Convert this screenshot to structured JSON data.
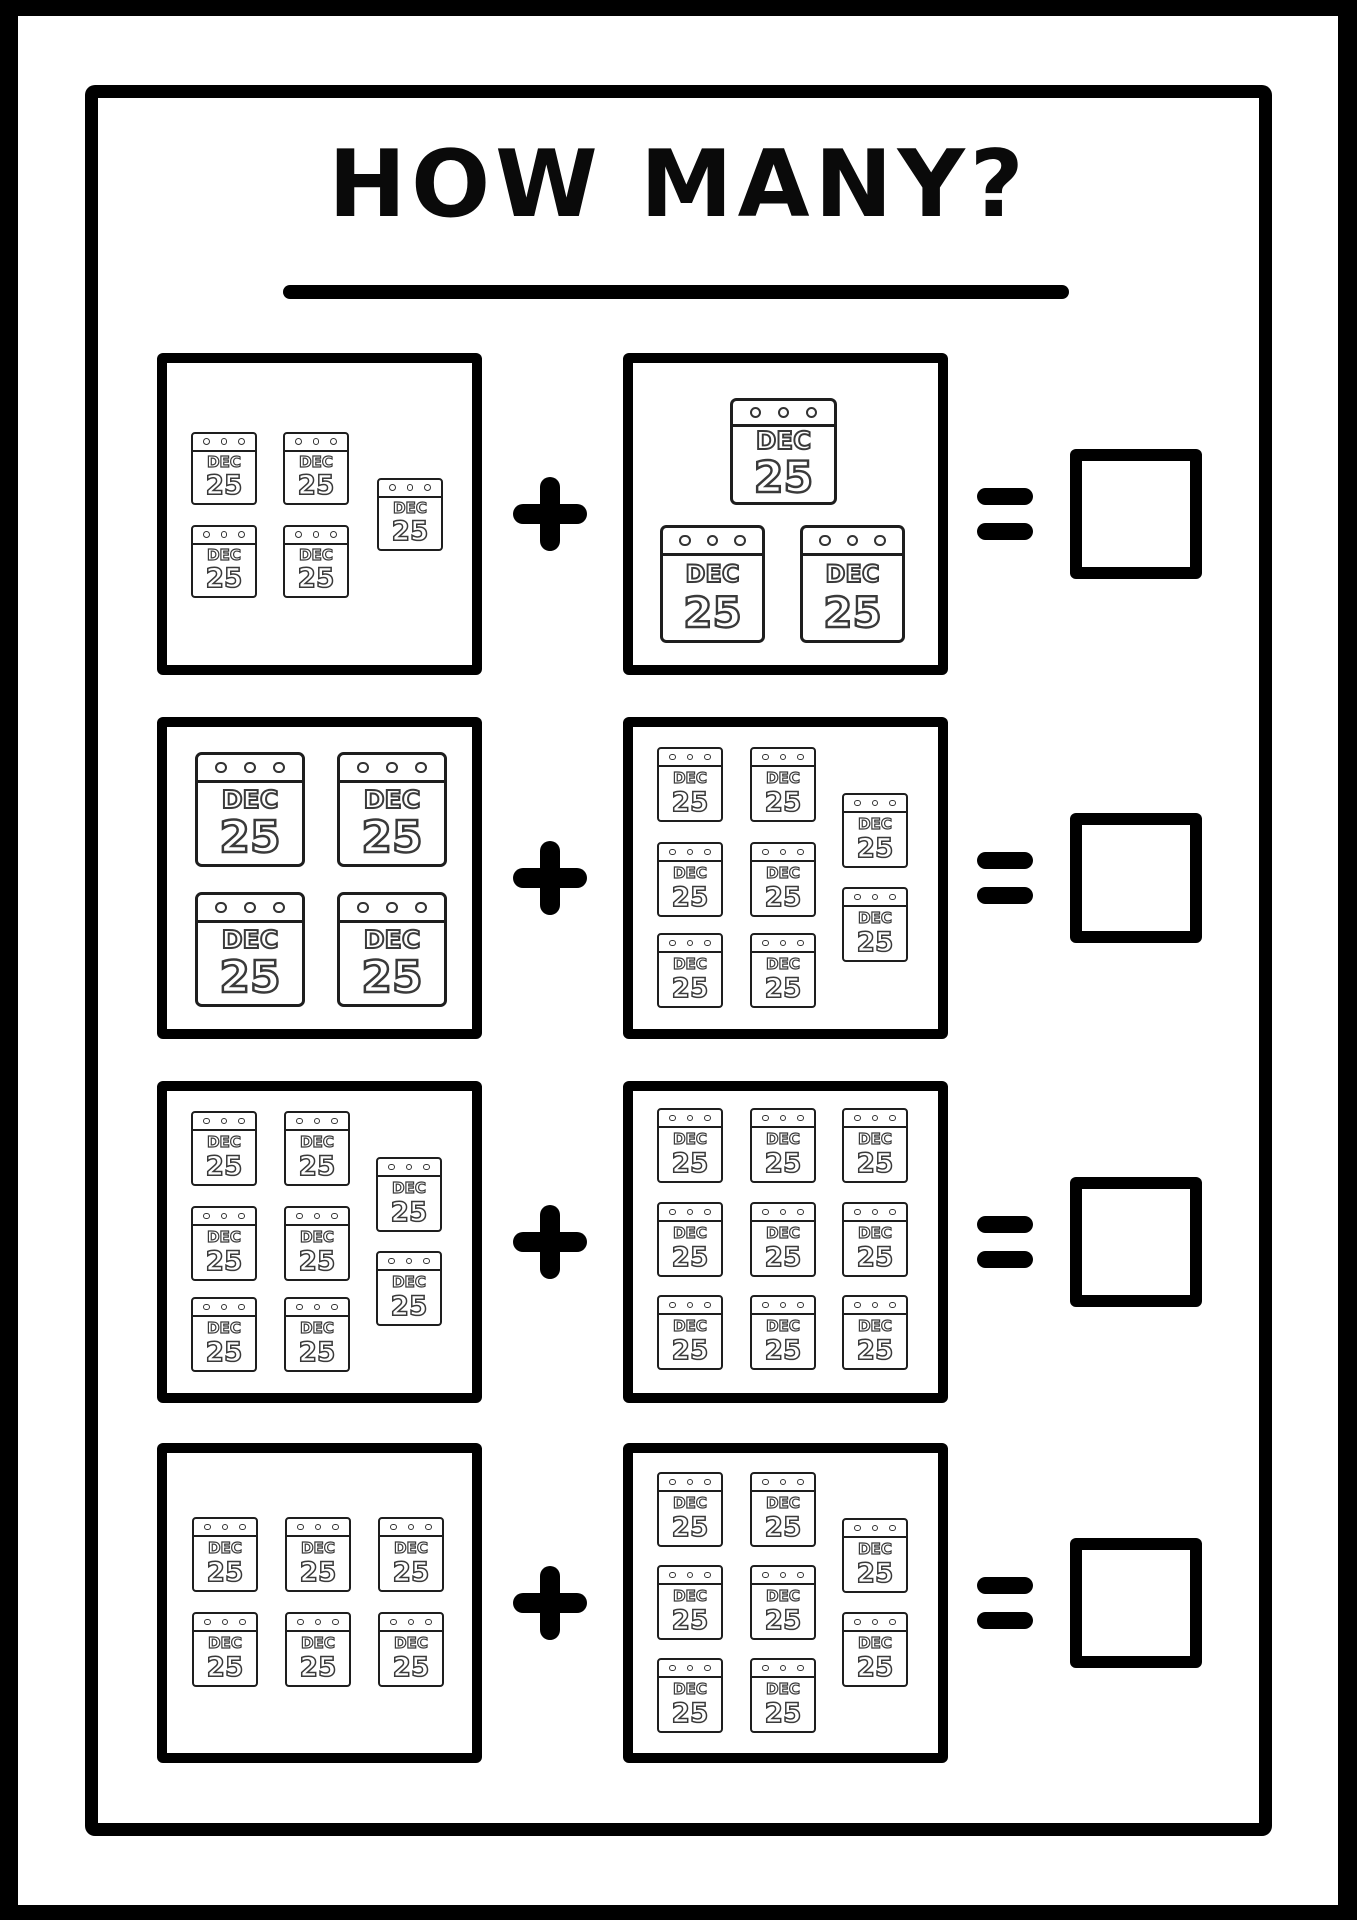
{
  "page": {
    "title": "HOW MANY?",
    "background": "#ffffff",
    "ink_color": "#000000"
  },
  "calendar_icon": {
    "name": "calendar-dec-25-icon",
    "month": "DEC",
    "day": "25",
    "line_color": "#1e1e1e",
    "glyph_outline_color": "#3a3a3a"
  },
  "equation": {
    "plus_symbol": "+",
    "equals_symbol": "=",
    "answer_value": ""
  },
  "rows": [
    {
      "row_label": "row-1",
      "left_count": 5,
      "right_count": 3,
      "left_calendars": [
        [
          34,
          79,
          66,
          73
        ],
        [
          126,
          79,
          66,
          73
        ],
        [
          34,
          172,
          66,
          73
        ],
        [
          126,
          172,
          66,
          73
        ],
        [
          220,
          125,
          66,
          73
        ]
      ],
      "right_calendars": [
        [
          107,
          45,
          107,
          107
        ],
        [
          37,
          172,
          105,
          118
        ],
        [
          177,
          172,
          105,
          118
        ]
      ]
    },
    {
      "row_label": "row-2",
      "left_count": 4,
      "right_count": 8,
      "left_calendars": [
        [
          38,
          35,
          110,
          115
        ],
        [
          180,
          35,
          110,
          115
        ],
        [
          38,
          175,
          110,
          115
        ],
        [
          180,
          175,
          110,
          115
        ]
      ],
      "right_calendars": [
        [
          34,
          30,
          66,
          75
        ],
        [
          127,
          30,
          66,
          75
        ],
        [
          34,
          125,
          66,
          75
        ],
        [
          127,
          125,
          66,
          75
        ],
        [
          34,
          216,
          66,
          75
        ],
        [
          127,
          216,
          66,
          75
        ],
        [
          219,
          76,
          66,
          75
        ],
        [
          219,
          170,
          66,
          75
        ]
      ]
    },
    {
      "row_label": "row-3",
      "left_count": 8,
      "right_count": 9,
      "left_calendars": [
        [
          34,
          30,
          66,
          75
        ],
        [
          127,
          30,
          66,
          75
        ],
        [
          34,
          125,
          66,
          75
        ],
        [
          127,
          125,
          66,
          75
        ],
        [
          34,
          216,
          66,
          75
        ],
        [
          127,
          216,
          66,
          75
        ],
        [
          219,
          76,
          66,
          75
        ],
        [
          219,
          170,
          66,
          75
        ]
      ],
      "right_calendars": [
        [
          34,
          27,
          66,
          75
        ],
        [
          127,
          27,
          66,
          75
        ],
        [
          219,
          27,
          66,
          75
        ],
        [
          34,
          121,
          66,
          75
        ],
        [
          127,
          121,
          66,
          75
        ],
        [
          219,
          121,
          66,
          75
        ],
        [
          34,
          214,
          66,
          75
        ],
        [
          127,
          214,
          66,
          75
        ],
        [
          219,
          214,
          66,
          75
        ]
      ]
    },
    {
      "row_label": "row-4",
      "left_count": 6,
      "right_count": 8,
      "left_calendars": [
        [
          35,
          74,
          66,
          75
        ],
        [
          128,
          74,
          66,
          75
        ],
        [
          221,
          74,
          66,
          75
        ],
        [
          35,
          169,
          66,
          75
        ],
        [
          128,
          169,
          66,
          75
        ],
        [
          221,
          169,
          66,
          75
        ]
      ],
      "right_calendars": [
        [
          34,
          29,
          66,
          75
        ],
        [
          127,
          29,
          66,
          75
        ],
        [
          34,
          122,
          66,
          75
        ],
        [
          127,
          122,
          66,
          75
        ],
        [
          34,
          215,
          66,
          75
        ],
        [
          127,
          215,
          66,
          75
        ],
        [
          219,
          75,
          66,
          75
        ],
        [
          219,
          169,
          66,
          75
        ]
      ]
    }
  ]
}
